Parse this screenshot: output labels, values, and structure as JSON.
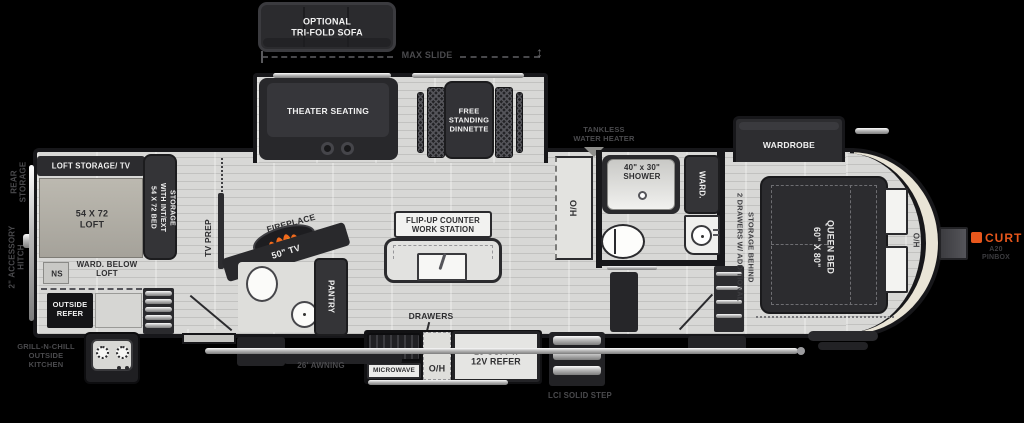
{
  "colors": {
    "background": "#000000",
    "floor": "#d8d8d6",
    "wall": "#17171a",
    "furniture": "#343437",
    "front_cap_cream": "#e9e4d6",
    "brand_orange": "#e8571c",
    "flame_orange": "#f06a1d",
    "flame_yellow": "#fbc02d",
    "exterior_label": "#4a4a4d",
    "interior_label": "#2e2e30"
  },
  "exterior": {
    "rear_storage": "REAR\nSTORAGE",
    "accessory_hitch": "2\" ACCESSORY\nHITCH",
    "outside_kitchen": "GRILL-N-CHILL\nOUTSIDE\nKITCHEN",
    "awning": "26' AWNING",
    "solid_step": "LCI SOLID STEP",
    "max_slide": "MAX SLIDE",
    "tankless_water_heater": "TANKLESS\nWATER HEATER",
    "hitch_brand": "CURT",
    "hitch_model": "A20\nPINBOX"
  },
  "slides": {
    "optional_sofa": "OPTIONAL\nTRI-FOLD SOFA",
    "theater_seating": "THEATER SEATING",
    "dinette": "FREE\nSTANDING\nDINNETTE",
    "wardrobe": "WARDROBE"
  },
  "loft": {
    "storage_tv": "LOFT STORAGE/ TV",
    "loft_size": "54 X 72\nLOFT",
    "bed_storage": "54 X 72 BED\nWITH INT/EXT\nSTORAGE",
    "nightstand": "NS",
    "ward_below": "WARD. BELOW\nLOFT",
    "outside_refer": "OUTSIDE\nREFER"
  },
  "galley": {
    "tv_prep": "TV PREP",
    "fireplace": "FIREPLACE",
    "tv": "50\" TV",
    "pantry": "PANTRY",
    "island": "FLIP-UP COUNTER\nWORK STATION",
    "drawers": "DRAWERS",
    "microwave": "MICROWAVE",
    "overhead": "O/H",
    "refrigerator": "16 CU. FT.\n12V REFER"
  },
  "bath": {
    "linen": "H/O",
    "shower": "40\" x 30\"\nSHOWER",
    "wardrobe": "WARD."
  },
  "bedroom": {
    "drawer_storage": "2 DRAWERS W/ ADDITIONAL\nSTORAGE BEHIND",
    "queen_bed": "60\" X 80\"\nQUEEN BED",
    "overhead": "H/O"
  }
}
